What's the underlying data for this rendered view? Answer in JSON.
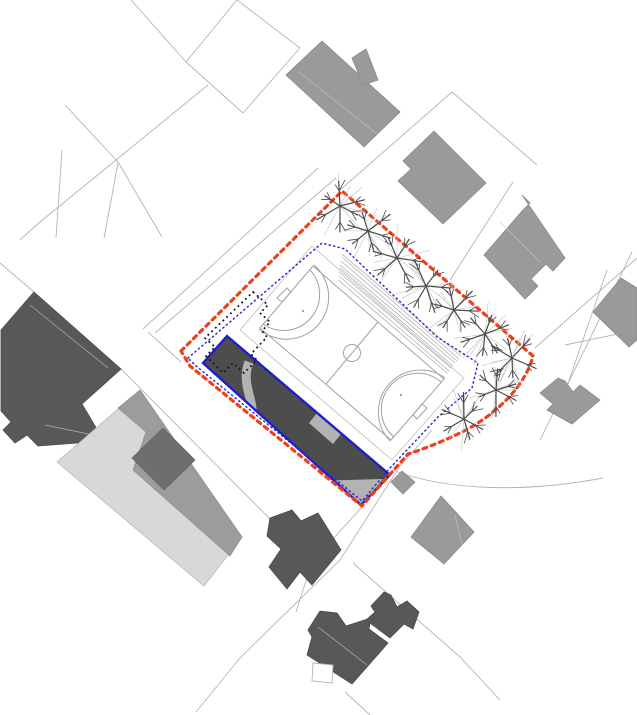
{
  "canvas": {
    "width": 637,
    "height": 715,
    "background": "#ffffff",
    "description": "architectural site plan drawing"
  },
  "colors": {
    "parcel": "#b4b4b4",
    "building_mid": "#9a9a9a",
    "building_mid_stroke": "#8a8a8a",
    "building_dark": "#585858",
    "building_dark_stroke": "#4a4a4a",
    "complex_light": "#d8d8d8",
    "complex_mid": "#9c9c9c",
    "complex_dark": "#6e6e6e",
    "site_boundary_red": "#f0401a",
    "site_inner_blue": "#2d2dcf",
    "existing_black": "#161616",
    "field_line": "#a2a2a2",
    "pad_stroke": "#bcbcbc",
    "proposed_fill": "#4d4d4d",
    "proposed_stroke": "#1e1ecc",
    "patch_gray": "#b3b3b3",
    "steps": "#b0b0b0",
    "tree_dark": "#4a4a4a",
    "tree_light": "#c3c3c3",
    "roof_line": "#c9c9c9"
  },
  "parcel_lines": [
    "M131,0 L186,62",
    "M237,0 L186,62",
    "M186,62 L243,113",
    "M243,113 L300,48",
    "M300,48 L237,0",
    "M208,85 L40,222 L20,240",
    "M65,105 L118,162 L162,237",
    "M62,150 L56,238",
    "M118,163 L104,238",
    "M452,92 L340,190",
    "M452,92 L537,165",
    "M513,182 L450,280",
    "M155,333 L336,178",
    "M143,329 L318,168",
    "M148,332 L181,362",
    "M121,369 L270,519",
    "M34,292 L0,263",
    "M432,430 L400,466 L340,560 L240,658 L196,712",
    "M362,507 L312,562 L296,612",
    "M632,252 L583,353 L540,440",
    "M607,270 L563,398",
    "M565,345 L637,330",
    "M535,348 L637,258",
    "M392,470 C450,492 530,492 603,478",
    "M353,563 L460,657 L500,700",
    "M345,692 L370,715"
  ],
  "buildings_mid": [
    {
      "pts": [
        [
          322,
          41
        ],
        [
          286,
          75
        ],
        [
          364,
          147
        ],
        [
          400,
          112
        ]
      ]
    },
    {
      "pts": [
        [
          352,
          58
        ],
        [
          366,
          49
        ],
        [
          378,
          80
        ],
        [
          363,
          85
        ]
      ]
    },
    {
      "pts": [
        [
          434,
          131
        ],
        [
          403,
          161
        ],
        [
          411,
          169
        ],
        [
          398,
          181
        ],
        [
          443,
          224
        ],
        [
          486,
          183
        ]
      ]
    },
    {
      "pts": [
        [
          522,
          195
        ],
        [
          530,
          203
        ],
        [
          522,
          211
        ],
        [
          484,
          255
        ],
        [
          525,
          299
        ],
        [
          538,
          286
        ],
        [
          531,
          279
        ],
        [
          546,
          264
        ],
        [
          553,
          271
        ],
        [
          565,
          258
        ]
      ]
    },
    {
      "pts": [
        [
          621,
          278
        ],
        [
          593,
          312
        ],
        [
          629,
          347
        ],
        [
          637,
          340
        ],
        [
          637,
          288
        ]
      ]
    },
    {
      "pts": [
        [
          558,
          378
        ],
        [
          540,
          393
        ],
        [
          553,
          404
        ],
        [
          547,
          410
        ],
        [
          572,
          424
        ],
        [
          600,
          400
        ],
        [
          580,
          385
        ],
        [
          573,
          392
        ],
        [
          565,
          381
        ]
      ]
    },
    {
      "pts": [
        [
          402,
          471
        ],
        [
          391,
          482
        ],
        [
          403,
          494
        ],
        [
          415,
          482
        ]
      ]
    },
    {
      "pts": [
        [
          441,
          496
        ],
        [
          411,
          537
        ],
        [
          444,
          564
        ],
        [
          474,
          532
        ]
      ]
    }
  ],
  "buildings_dark": [
    {
      "pts": [
        [
          34,
          292
        ],
        [
          121,
          369
        ],
        [
          82,
          404
        ],
        [
          104,
          441
        ],
        [
          38,
          446
        ],
        [
          27,
          435
        ],
        [
          15,
          443
        ],
        [
          3,
          430
        ],
        [
          11,
          422
        ],
        [
          1,
          411
        ],
        [
          1,
          330
        ]
      ]
    },
    {
      "pts": [
        [
          270,
          518
        ],
        [
          292,
          510
        ],
        [
          301,
          521
        ],
        [
          318,
          513
        ],
        [
          341,
          550
        ],
        [
          312,
          585
        ],
        [
          300,
          572
        ],
        [
          287,
          589
        ],
        [
          269,
          567
        ],
        [
          281,
          549
        ],
        [
          267,
          536
        ]
      ]
    },
    {
      "pts": [
        [
          320,
          611
        ],
        [
          308,
          630
        ],
        [
          312,
          637
        ],
        [
          307,
          655
        ],
        [
          352,
          684
        ],
        [
          388,
          643
        ],
        [
          369,
          629
        ],
        [
          371,
          618
        ],
        [
          346,
          626
        ],
        [
          337,
          613
        ]
      ]
    },
    {
      "pts": [
        [
          384,
          592
        ],
        [
          371,
          606
        ],
        [
          375,
          612
        ],
        [
          366,
          620
        ],
        [
          390,
          638
        ],
        [
          404,
          624
        ],
        [
          413,
          629
        ],
        [
          419,
          612
        ],
        [
          407,
          601
        ],
        [
          397,
          607
        ],
        [
          391,
          595
        ]
      ]
    }
  ],
  "terraced_complex": {
    "light": [
      [
        140,
        390
      ],
      [
        57,
        462
      ],
      [
        204,
        586
      ],
      [
        242,
        537
      ]
    ],
    "mid": [
      [
        140,
        390
      ],
      [
        242,
        537
      ],
      [
        230,
        556
      ],
      [
        133,
        470
      ],
      [
        146,
        432
      ],
      [
        118,
        408
      ]
    ],
    "dark": [
      [
        163,
        428
      ],
      [
        132,
        458
      ],
      [
        164,
        490
      ],
      [
        195,
        460
      ]
    ]
  },
  "roof_lines": [
    "M299,72 L377,134",
    "M30,305 L108,368",
    "M45,425 L98,436",
    "M318,627 L367,665",
    "M500,222 L540,262",
    "M455,515 L462,545"
  ],
  "site": {
    "boundary_path": "M181,351 L342,191 L533,356 C525,388 492,418 458,434 C441,442 424,449 408,454 L362,506 L190,366 Z",
    "inner_path": "M188,358 L322,243 L345,249 L437,337 L478,363 L472,388 L438,417 L406,451 L390,468 L362,501 L196,366 Z",
    "existing_outline_path": "M253,292 L268,305 L260,313 L270,322 L262,331 L267,337 L251,354 L257,360 L244,373 L233,363 L223,373 L206,356 L215,347 L205,338 Z",
    "pad": [
      [
        312,
        246
      ],
      [
        464,
        378
      ],
      [
        392,
        460
      ],
      [
        240,
        330
      ]
    ],
    "court": [
      [
        313,
        266
      ],
      [
        444,
        379
      ],
      [
        391,
        440
      ],
      [
        260,
        328
      ]
    ],
    "court_lines": [
      "M326,384 L378,322",
      "M310,270 A36,36 0 0 1 263,324",
      "M314,265 A42,42 0 0 1 259,329",
      "M441,382 A36,36 0 0 0 394,437",
      "M445,378 A42,42 0 0 0 390,441"
    ],
    "center_circle": {
      "cx": 352,
      "cy": 353,
      "r": 8.5
    },
    "penalty_marks": [
      [
        303,
        311
      ],
      [
        401,
        395
      ]
    ],
    "goals": [
      [
        [
          291,
          292
        ],
        [
          282,
          302
        ],
        [
          277,
          298
        ],
        [
          287,
          288
        ]
      ],
      [
        [
          422,
          404
        ],
        [
          413,
          415
        ],
        [
          417,
          419
        ],
        [
          427,
          408
        ]
      ]
    ],
    "steps": [
      [
        338,
        280,
        447,
        373
      ],
      [
        339,
        276,
        449,
        371
      ],
      [
        339,
        272,
        451,
        368
      ],
      [
        340,
        268,
        453,
        366
      ],
      [
        340,
        265,
        455,
        363
      ],
      [
        341,
        261,
        457,
        361
      ],
      [
        342,
        257,
        459,
        359
      ],
      [
        342,
        254,
        461,
        356
      ]
    ],
    "trees": {
      "centers": [
        [
          340,
          206
        ],
        [
          368,
          231
        ],
        [
          397,
          258
        ],
        [
          426,
          286
        ],
        [
          454,
          310
        ],
        [
          485,
          334
        ],
        [
          512,
          358
        ],
        [
          496,
          390
        ],
        [
          464,
          419
        ]
      ],
      "crown_radius": 30
    },
    "proposed_building": {
      "pts": [
        [
          227,
          336
        ],
        [
          203,
          363
        ],
        [
          361,
          505
        ],
        [
          390,
          475
        ]
      ],
      "ribbon_path": "M249,362 C240,385 256,402 251,416 C248,425 252,434 255,443",
      "patches": [
        [
          [
            317,
            413
          ],
          [
            341,
            434
          ],
          [
            333,
            444
          ],
          [
            309,
            423
          ]
        ],
        [
          [
            312,
            481
          ],
          [
            383,
            479
          ],
          [
            362,
            506
          ]
        ]
      ]
    },
    "yard_square": [
      [
        313,
        663
      ],
      [
        312,
        681
      ],
      [
        332,
        683
      ],
      [
        333,
        665
      ]
    ]
  }
}
